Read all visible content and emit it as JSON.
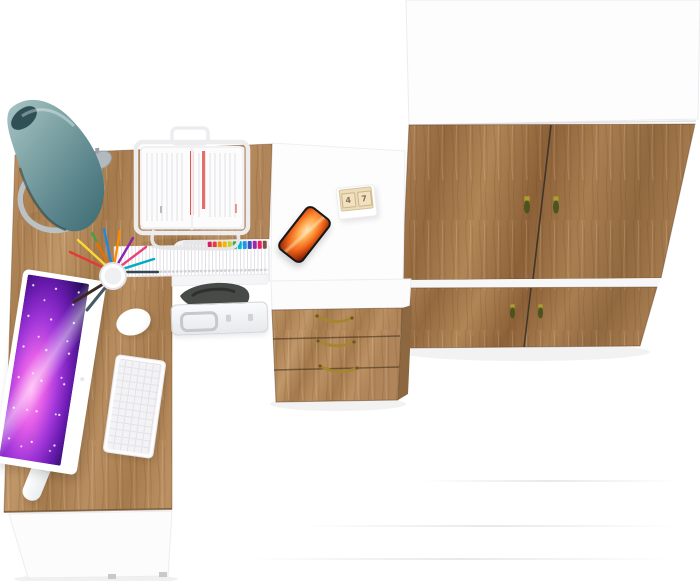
{
  "meta": {
    "description": "Top-down 3D render of a two-tone office furniture set (white and craft oak): L-shaped desk with accessories, three-drawer pedestal and a wardrobe",
    "view": "top-down product render",
    "canvas": {
      "width": 700,
      "height": 581
    }
  },
  "palette": {
    "background": "#ffffff",
    "white_surface": "#fdfdfe",
    "desk_wood": "#b3885a",
    "wardrobe_wood": "#a07749",
    "drawer_side_wood": "#8d673f",
    "lamp_shade_teal": "#5f878d",
    "lamp_base_gray": "#bac2c5",
    "brass_handle": "#a3862f",
    "handle_tassel_green": "#4c531f",
    "monitor_screen_purple": "#8a2be2",
    "phone_screen_orange": "#f1661a",
    "document_red_stripe": "#e25550",
    "pen_colors": [
      "#e53935",
      "#fdd835",
      "#43a047",
      "#1e88e5",
      "#fb8c00",
      "#8e24aa",
      "#ec407a",
      "#00acc1",
      "#37474f",
      "#ef6c00",
      "#3e2723",
      "#455a64"
    ],
    "file_tab_colors": [
      "#e91e63",
      "#f44336",
      "#ff9800",
      "#ffc107",
      "#cddc39",
      "#4caf50",
      "#00bcd4",
      "#2196f3",
      "#3f51b5",
      "#9c27b0",
      "#e91e63",
      "#795548"
    ]
  },
  "objects": {
    "wardrobe": {
      "label": "wardrobe with white top, four oak doors and brass tassel pulls",
      "door_count": 4,
      "handle_count": 4
    },
    "desk": {
      "label": "L-shaped corner desk, oak worktop with white return and front panel"
    },
    "drawer_unit": {
      "label": "three-drawer pedestal with white top, oak fronts and brass bail handles",
      "drawer_count": 3
    },
    "monitor": {
      "label": "white all-in-one computer showing purple galaxy wallpaper"
    },
    "keyboard": {
      "label": "white keyboard"
    },
    "mouse": {
      "label": "white mouse"
    },
    "lamp": {
      "label": "teal cone desk lamp with gray ring base"
    },
    "paper_tray": {
      "label": "white wire document stand holding papers with red stripes"
    },
    "pen_cup": {
      "label": "white pen cup with colored pens and pencils"
    },
    "files_row": {
      "label": "row of white files with colored index tabs on under-desk shelf"
    },
    "chair": {
      "label": "dark seat visible under the desk"
    },
    "briefcase": {
      "label": "light aluminum briefcase under the desk"
    },
    "phone": {
      "label": "smartphone with fiery orange wallpaper"
    },
    "desk_calendar": {
      "label": "wooden block calendar",
      "cards": [
        "4",
        "7"
      ]
    }
  }
}
